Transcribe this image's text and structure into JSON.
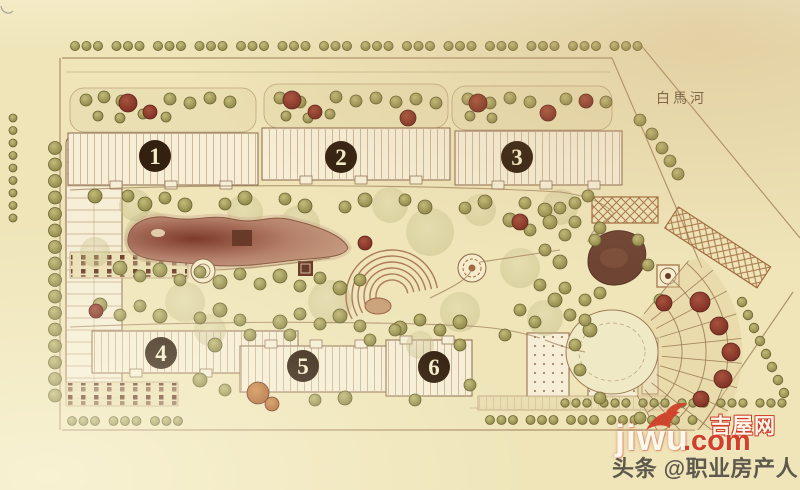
{
  "palette": {
    "paper": "#efe5b9",
    "paper_light": "#f5eccb",
    "ink": "#8a684a",
    "road": "#a4845f",
    "building_fill": "#f6eed6",
    "hatch": "#bb9c78",
    "strip_fill": "#eadfb2",
    "olive1": "#c2bb79",
    "olive2": "#8d8546",
    "olive_stroke": "#6b6434",
    "sage": "#b7ae72",
    "red1": "#a8523d",
    "red2": "#7c2f22",
    "red_stroke": "#5e241a",
    "orange1": "#cf8a4a",
    "orange2": "#a85a28",
    "pond1": "#b5806a",
    "pond2": "#7e3a2a",
    "pond_edge": "#8a5a42",
    "pool": "#6f4433",
    "structure": "#6a3a28",
    "trellis": "#a06a3e",
    "fan_line": "#9b7b55",
    "amphi": "#9c5f45",
    "badge_bg": "#33200f",
    "badge_fg": "#f5ecca",
    "river_text": "#6b5a3f",
    "wm_red": "#d0402a",
    "wm_white": "#fdf8ec",
    "byline": "#45413a"
  },
  "labels": {
    "river": "白馬河",
    "buildings": [
      "1",
      "2",
      "3",
      "4",
      "5",
      "6"
    ]
  },
  "watermark": {
    "site_name": "吉屋网",
    "domain": "jiwu",
    "tld": ".com",
    "byline": "头条 @职业房产人"
  },
  "trees": {
    "street_rows": [
      {
        "x": 75,
        "y": 46,
        "n": 42,
        "step": 11.5,
        "gap": 7,
        "r": 4.6
      },
      {
        "x": 13,
        "y": 118,
        "n": 9,
        "vstep": 12.5,
        "r": 4
      },
      {
        "x": 55,
        "y": 148,
        "n": 16,
        "vstep": 16.5,
        "r": 6.5
      },
      {
        "x": 72,
        "y": 421,
        "n": 9,
        "step": 11.5,
        "gap": 7,
        "r": 4.5
      },
      {
        "x": 490,
        "y": 420,
        "n": 16,
        "step": 11.5,
        "gap": 6,
        "r": 4.5
      },
      {
        "x": 565,
        "y": 403,
        "n": 18,
        "step": 11,
        "gap": 6,
        "r": 4.2
      },
      {
        "x": 742,
        "y": 302,
        "n": 8,
        "step": 6,
        "vstep": 13,
        "r": 4.8
      }
    ],
    "sage": [
      [
        150,
        237,
        26
      ],
      [
        250,
        247,
        22
      ],
      [
        430,
        232,
        24
      ],
      [
        330,
        302,
        22
      ],
      [
        520,
        268,
        20
      ],
      [
        185,
        302,
        20
      ],
      [
        95,
        252,
        15
      ],
      [
        560,
        207,
        18
      ],
      [
        612,
        330,
        20
      ],
      [
        245,
        212,
        18
      ],
      [
        460,
        312,
        20
      ],
      [
        545,
        318,
        18
      ],
      [
        135,
        205,
        16
      ],
      [
        390,
        205,
        18
      ],
      [
        300,
        225,
        20
      ],
      [
        210,
        330,
        16
      ],
      [
        420,
        345,
        14
      ],
      [
        480,
        210,
        16
      ]
    ],
    "olive": [
      [
        86,
        100,
        6
      ],
      [
        104,
        97,
        6
      ],
      [
        122,
        101,
        6
      ],
      [
        170,
        99,
        6
      ],
      [
        190,
        103,
        6
      ],
      [
        210,
        98,
        6
      ],
      [
        230,
        102,
        6
      ],
      [
        98,
        116,
        5
      ],
      [
        120,
        118,
        5
      ],
      [
        143,
        114,
        5
      ],
      [
        166,
        117,
        5
      ],
      [
        280,
        98,
        6
      ],
      [
        300,
        102,
        6
      ],
      [
        336,
        97,
        6
      ],
      [
        356,
        101,
        6
      ],
      [
        376,
        98,
        6
      ],
      [
        396,
        102,
        6
      ],
      [
        416,
        99,
        6
      ],
      [
        436,
        103,
        6
      ],
      [
        286,
        116,
        5
      ],
      [
        308,
        118,
        5
      ],
      [
        330,
        114,
        5
      ],
      [
        468,
        99,
        6
      ],
      [
        490,
        103,
        6
      ],
      [
        510,
        98,
        6
      ],
      [
        530,
        102,
        6
      ],
      [
        566,
        99,
        6
      ],
      [
        606,
        102,
        6
      ],
      [
        470,
        116,
        5
      ],
      [
        492,
        118,
        5
      ],
      [
        95,
        196,
        7
      ],
      [
        128,
        196,
        6
      ],
      [
        145,
        204,
        7
      ],
      [
        165,
        198,
        6
      ],
      [
        185,
        205,
        7
      ],
      [
        225,
        204,
        6
      ],
      [
        245,
        198,
        7
      ],
      [
        285,
        199,
        6
      ],
      [
        305,
        206,
        7
      ],
      [
        345,
        207,
        6
      ],
      [
        365,
        200,
        7
      ],
      [
        405,
        200,
        6
      ],
      [
        425,
        207,
        7
      ],
      [
        465,
        208,
        6
      ],
      [
        485,
        202,
        7
      ],
      [
        525,
        203,
        6
      ],
      [
        545,
        210,
        7
      ],
      [
        120,
        268,
        7
      ],
      [
        140,
        276,
        6
      ],
      [
        160,
        270,
        7
      ],
      [
        180,
        280,
        6
      ],
      [
        200,
        272,
        6
      ],
      [
        220,
        282,
        7
      ],
      [
        240,
        274,
        6
      ],
      [
        260,
        284,
        6
      ],
      [
        280,
        276,
        7
      ],
      [
        300,
        286,
        6
      ],
      [
        320,
        278,
        6
      ],
      [
        340,
        288,
        7
      ],
      [
        360,
        280,
        6
      ],
      [
        100,
        305,
        7
      ],
      [
        120,
        315,
        6
      ],
      [
        140,
        306,
        6
      ],
      [
        160,
        316,
        7
      ],
      [
        200,
        318,
        6
      ],
      [
        220,
        310,
        7
      ],
      [
        240,
        320,
        6
      ],
      [
        280,
        322,
        7
      ],
      [
        300,
        314,
        6
      ],
      [
        320,
        324,
        6
      ],
      [
        340,
        316,
        7
      ],
      [
        360,
        326,
        6
      ],
      [
        400,
        328,
        7
      ],
      [
        420,
        320,
        6
      ],
      [
        440,
        330,
        6
      ],
      [
        460,
        322,
        7
      ],
      [
        510,
        220,
        7
      ],
      [
        530,
        230,
        6
      ],
      [
        550,
        222,
        7
      ],
      [
        545,
        250,
        6
      ],
      [
        560,
        262,
        7
      ],
      [
        540,
        285,
        6
      ],
      [
        555,
        300,
        7
      ],
      [
        520,
        310,
        6
      ],
      [
        535,
        322,
        6
      ],
      [
        570,
        315,
        6
      ],
      [
        585,
        300,
        6
      ],
      [
        575,
        222,
        6
      ],
      [
        595,
        240,
        6
      ],
      [
        590,
        330,
        7
      ],
      [
        505,
        335,
        6
      ],
      [
        215,
        345,
        7
      ],
      [
        225,
        390,
        6
      ],
      [
        200,
        380,
        7
      ],
      [
        315,
        400,
        6
      ],
      [
        345,
        398,
        7
      ],
      [
        370,
        340,
        6
      ],
      [
        395,
        330,
        6
      ],
      [
        460,
        345,
        6
      ],
      [
        470,
        385,
        6
      ],
      [
        415,
        400,
        6
      ],
      [
        290,
        335,
        6
      ],
      [
        250,
        335,
        6
      ],
      [
        640,
        120,
        6
      ],
      [
        652,
        134,
        6
      ],
      [
        662,
        148,
        6
      ],
      [
        670,
        161,
        6
      ],
      [
        678,
        174,
        6
      ],
      [
        560,
        208,
        6
      ],
      [
        575,
        203,
        6
      ],
      [
        588,
        196,
        6
      ],
      [
        585,
        320,
        6
      ],
      [
        575,
        345,
        6
      ],
      [
        580,
        370,
        6
      ],
      [
        600,
        398,
        6
      ],
      [
        640,
        418,
        6
      ],
      [
        660,
        300,
        6
      ],
      [
        565,
        235,
        6
      ],
      [
        600,
        228,
        6
      ],
      [
        638,
        240,
        6
      ],
      [
        648,
        265,
        6
      ],
      [
        600,
        293,
        6
      ],
      [
        565,
        288,
        6
      ]
    ],
    "red": [
      [
        128,
        103,
        9
      ],
      [
        150,
        112,
        7
      ],
      [
        292,
        100,
        9
      ],
      [
        315,
        112,
        7
      ],
      [
        408,
        118,
        8
      ],
      [
        478,
        103,
        9
      ],
      [
        548,
        113,
        8
      ],
      [
        586,
        101,
        7
      ],
      [
        365,
        243,
        7
      ],
      [
        520,
        222,
        8
      ],
      [
        96,
        311,
        7
      ],
      [
        700,
        302,
        10
      ],
      [
        719,
        326,
        9
      ],
      [
        731,
        352,
        9
      ],
      [
        723,
        379,
        9
      ],
      [
        701,
        399,
        8
      ],
      [
        664,
        303,
        8
      ]
    ],
    "orange": [
      [
        258,
        393,
        11
      ],
      [
        272,
        404,
        7
      ]
    ]
  },
  "fan": {
    "cx": 612,
    "cy": 352,
    "r_inner": 50,
    "r_outer": 130,
    "angle_start": -50,
    "angle_end": 60,
    "rings": [
      70,
      94,
      116
    ],
    "spoke_step": 11
  },
  "amphitheater": {
    "cx": 392,
    "cy": 296,
    "radii": [
      16,
      22,
      28,
      34,
      40,
      46
    ],
    "angle_start": 150,
    "angle_end": 350
  }
}
